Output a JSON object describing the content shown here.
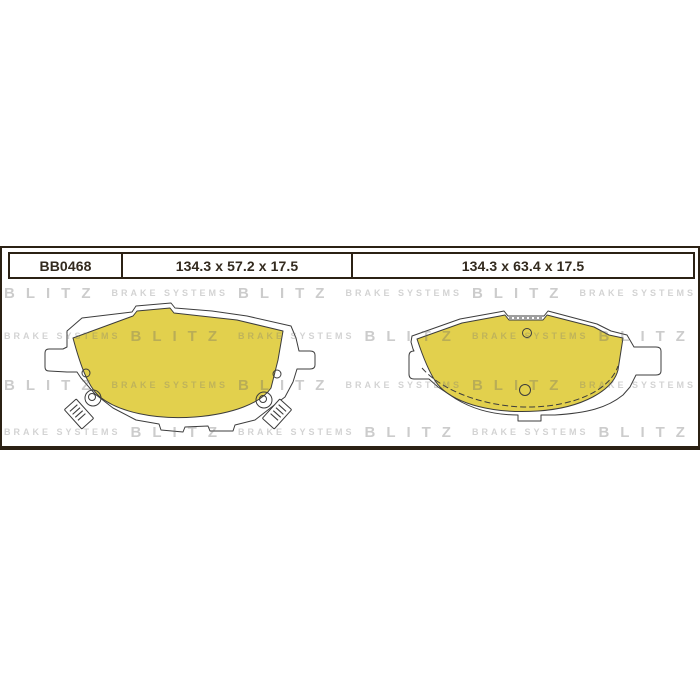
{
  "product": {
    "part_number": "BB0468",
    "dimensions": [
      "134.3 x 57.2 x 17.5",
      "134.3 x 63.4 x 17.5"
    ]
  },
  "watermark": {
    "brand": "BLITZ",
    "tagline": "BRAKE SYSTEMS",
    "rows": [
      "brand",
      "tagline",
      "brand",
      "tagline"
    ],
    "repeats_per_row": 6
  },
  "colors": {
    "friction_yellow": "#e2d04d",
    "frame_dark": "#2b2114",
    "drawing_outline": "#3c3c3c",
    "watermark_gray": "#d2d2d2"
  }
}
